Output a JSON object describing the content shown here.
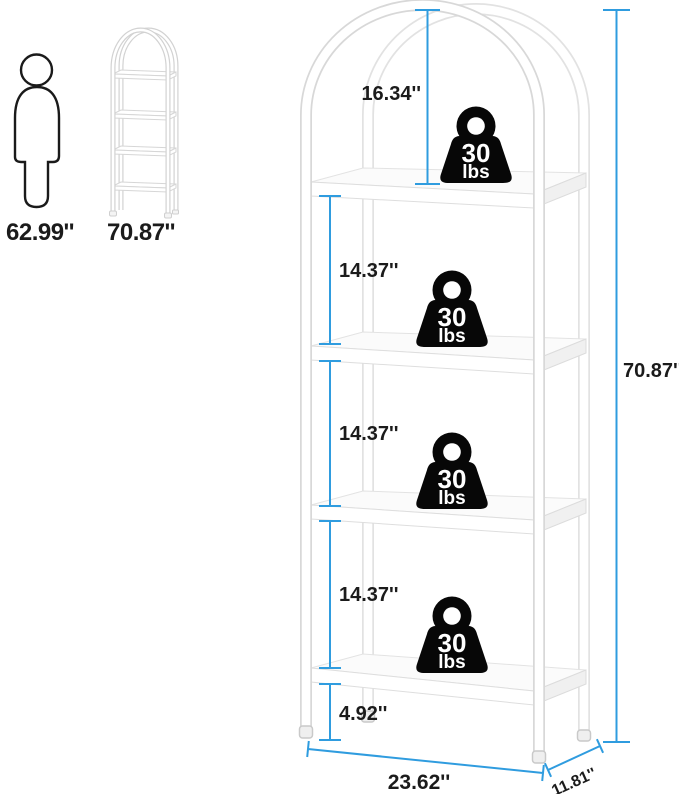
{
  "page": {
    "background": "#FFFFFF"
  },
  "reference": {
    "human": {
      "icon": "person-outline",
      "height_label": "62.99''"
    },
    "bookshelf": {
      "icon": "arched-bookshelf-outline",
      "height_label": "70.87''"
    }
  },
  "product": {
    "shelf_capacity": {
      "icon": "weight-kettlebell",
      "value": "30",
      "unit": "lbs"
    }
  },
  "dimensions": {
    "arch_to_top_shelf": "16.34''",
    "shelf_gaps": [
      "14.37''",
      "14.37''",
      "14.37''"
    ],
    "bottom_clearance": "4.92''",
    "total_height": "70.87''",
    "width": "23.62''",
    "depth": "11.81''"
  },
  "colors": {
    "dimension_line": "#2F9CDF",
    "weight_icon": "#070707",
    "frame_outline": "#D8D8D8",
    "text": "#1B1B1B"
  }
}
